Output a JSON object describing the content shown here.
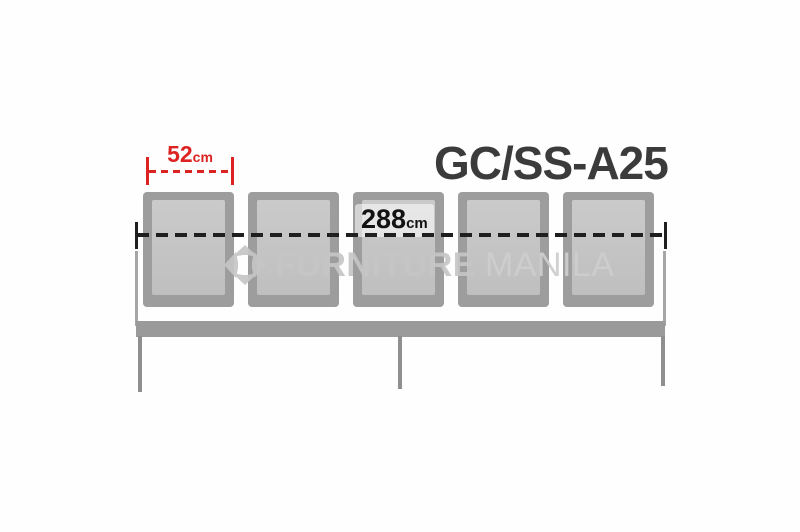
{
  "product": {
    "model_code": "GC/SS-A25",
    "description": "5-seater gang chair, front elevation diagram"
  },
  "bench": {
    "seat_count": 5
  },
  "dimensions": {
    "seat_width": {
      "value": "52",
      "unit": "cm"
    },
    "overall_width": {
      "value": "288",
      "unit": "cm"
    }
  },
  "watermark": {
    "word1": "FURNITURE",
    "word2": "MANILA",
    "icon": "furniture-manila-diamond-logo"
  },
  "colors": {
    "dimension_accent_red": "#dd2222",
    "dimension_line_black": "#1f1f1f",
    "seat_frame_gray": "#9d9d9d",
    "seat_panel_gray": "#c5c5c5",
    "beam_gray": "#9a9a9a",
    "leg_gray": "#8f8f8f",
    "title_gray": "#3b3b3b",
    "watermark_gray": "#c7c7c7"
  }
}
